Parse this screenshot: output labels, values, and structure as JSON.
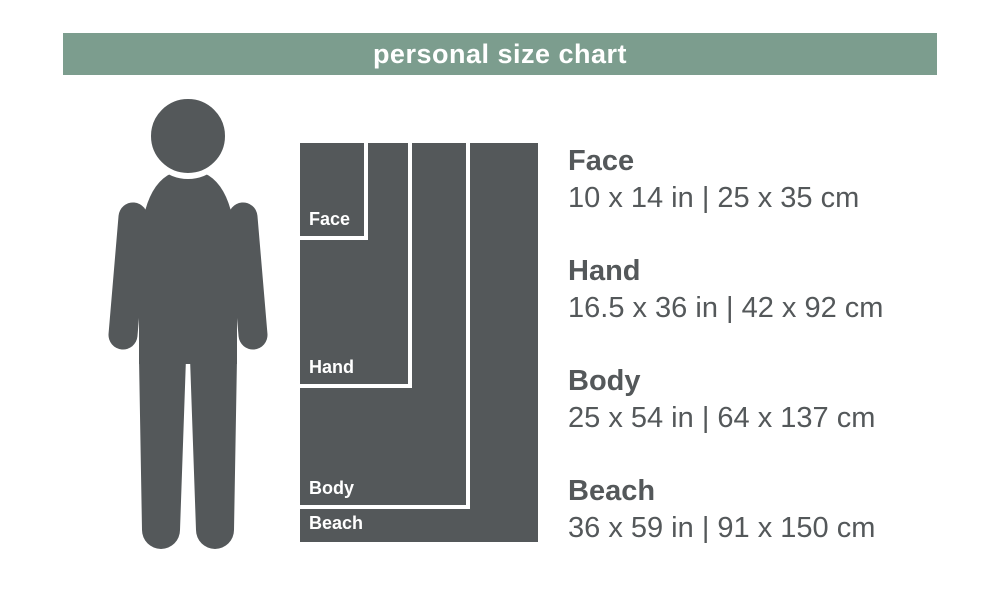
{
  "header": {
    "title": "personal size chart"
  },
  "colors": {
    "accent_green": "#7c9d8e",
    "dark_gray": "#54585a",
    "label_white": "#ffffff"
  },
  "figure": {
    "icon": "person-silhouette-icon"
  },
  "sizes": [
    {
      "name": "Face",
      "dimensions": "10 x 14 in | 25 x 35 cm"
    },
    {
      "name": "Hand",
      "dimensions": "16.5 x 36 in | 42 x 92 cm"
    },
    {
      "name": "Body",
      "dimensions": "25 x 54 in | 64 x 137 cm"
    },
    {
      "name": "Beach",
      "dimensions": "36 x 59 in | 91 x 150 cm"
    }
  ]
}
